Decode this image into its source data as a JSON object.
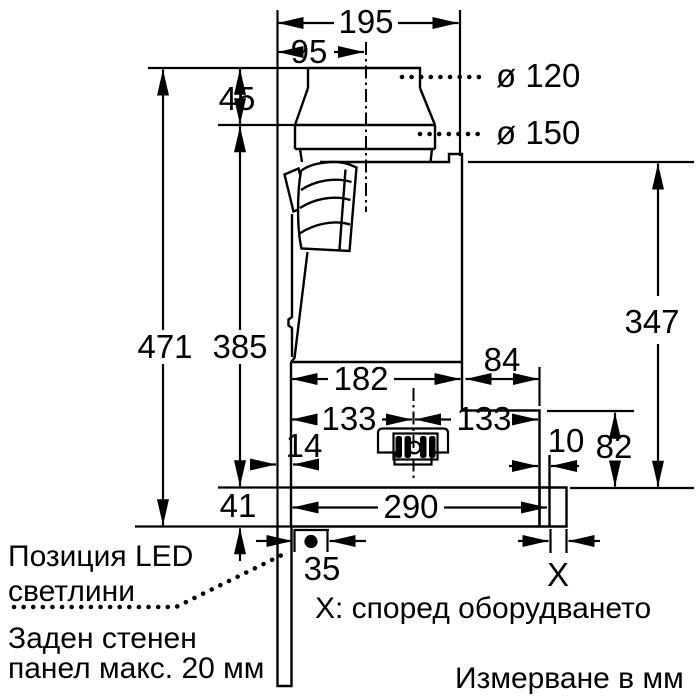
{
  "diagram": {
    "dimensions": {
      "width_top": "195",
      "duct_center_offset": "95",
      "collar_height": "45",
      "diameter_small": "ø 120",
      "diameter_large": "ø 150",
      "height_total": "471",
      "height_body": "385",
      "height_right": "347",
      "depth_front": "182",
      "depth_rear": "84",
      "center_to_front": "133",
      "center_to_rear": "133",
      "offset_front": "14",
      "offset_rear": "10",
      "height_lower_right": "82",
      "height_bottom_bar": "41",
      "width_bottom_bar": "290",
      "led_offset": "35",
      "x_dim": "X"
    },
    "notes": {
      "led_position_line1": "Позиция LED",
      "led_position_line2": "светлини",
      "rear_panel_line1": "Заден стенен",
      "rear_panel_line2": "панел макс. 20 мм",
      "x_note": "X: според оборудването",
      "units_note": "Измерване в мм"
    },
    "colors": {
      "ink": "#000000",
      "paper": "#ffffff"
    }
  }
}
